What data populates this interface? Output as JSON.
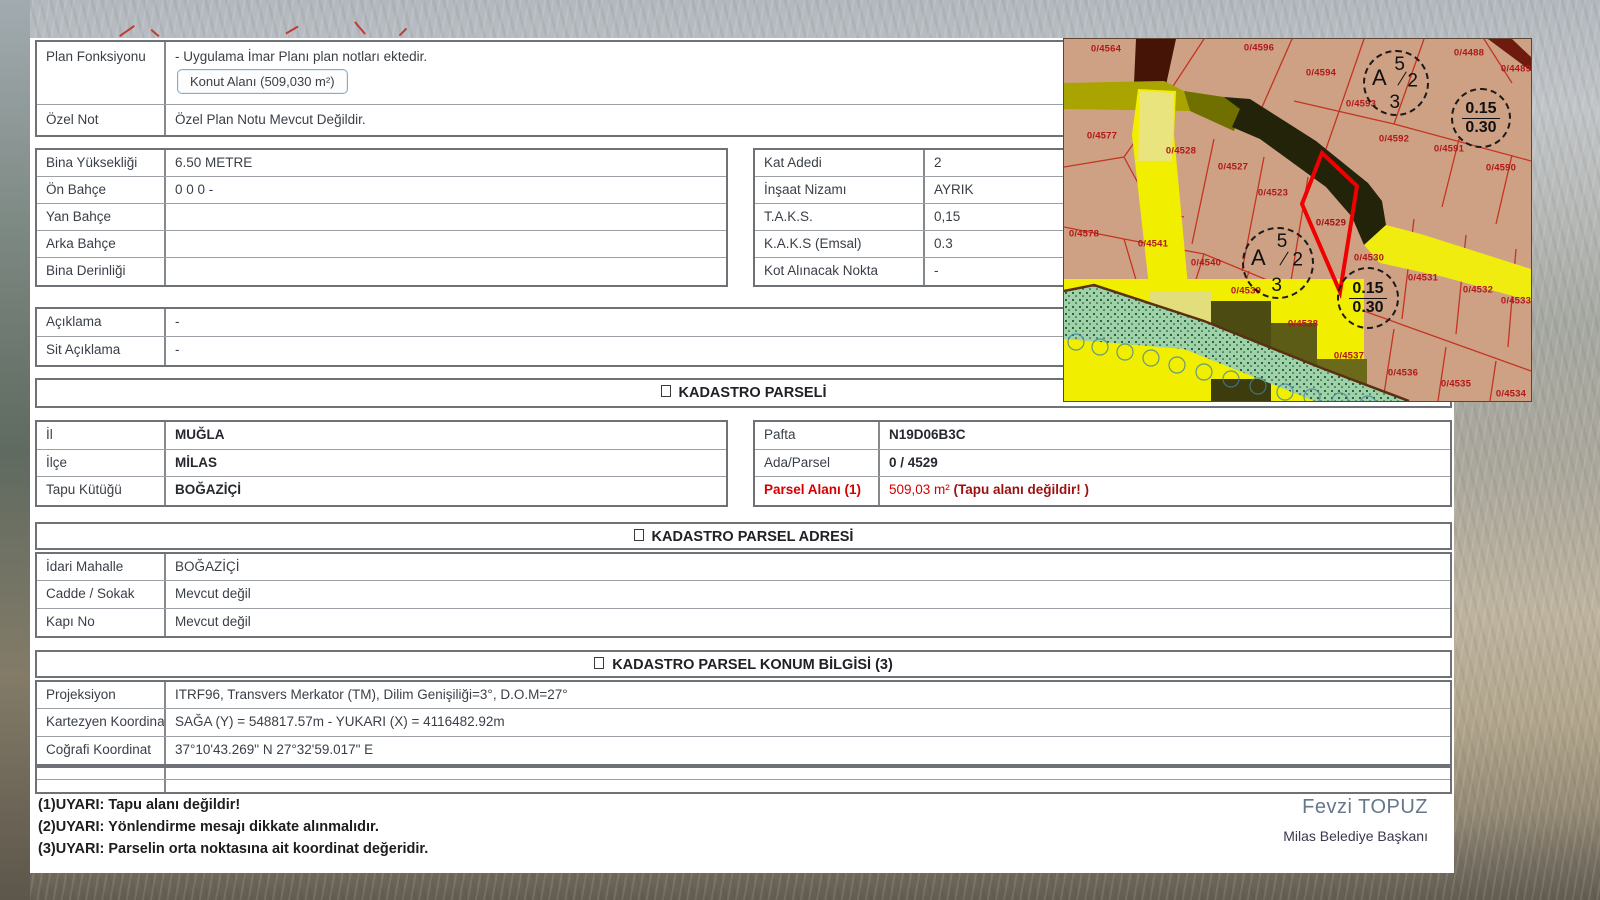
{
  "plan": {
    "rows": [
      {
        "label": "Plan Fonksiyonu",
        "text": "- Uygulama İmar Planı plan notları ektedir.",
        "button": "Konut Alanı (509,030 m²)"
      },
      {
        "label": "Özel Not",
        "value": "Özel Plan Notu Mevcut Değildir."
      }
    ]
  },
  "yapilasma_left": {
    "rows": [
      {
        "label": "Bina Yüksekliği",
        "value": "6.50 METRE"
      },
      {
        "label": "Ön Bahçe",
        "value": "0 0 0 -"
      },
      {
        "label": "Yan Bahçe",
        "value": ""
      },
      {
        "label": "Arka Bahçe",
        "value": ""
      },
      {
        "label": "Bina Derinliği",
        "value": ""
      }
    ]
  },
  "yapilasma_right": {
    "rows": [
      {
        "label": "Kat Adedi",
        "value": "2"
      },
      {
        "label": "İnşaat Nizamı",
        "value": "AYRIK"
      },
      {
        "label": "T.A.K.S.",
        "value": "0,15"
      },
      {
        "label": "K.A.K.S (Emsal)",
        "value": "0.3"
      },
      {
        "label": "Kot Alınacak Nokta",
        "value": "-"
      }
    ]
  },
  "aciklama": {
    "rows": [
      {
        "label": "Açıklama",
        "value": "-"
      },
      {
        "label": "Sit Açıklama",
        "value": "-"
      }
    ]
  },
  "kadastro_parseli": {
    "title": "KADASTRO PARSELİ",
    "left_rows": [
      {
        "label": "İl",
        "value": "MUĞLA"
      },
      {
        "label": "İlçe",
        "value": "MİLAS"
      },
      {
        "label": "Tapu Kütüğü",
        "value": "BOĞAZİÇİ"
      }
    ],
    "right_rows": [
      {
        "label": "Pafta",
        "value": "N19D06B3C"
      },
      {
        "label": "Ada/Parsel",
        "value": "0 / 4529"
      }
    ],
    "parsel_alani_label": "Parsel Alanı (1)",
    "parsel_alani_value": "509,03 m²",
    "parsel_alani_note": " (Tapu alanı değildir! )"
  },
  "adres": {
    "title": "KADASTRO PARSEL ADRESİ",
    "rows": [
      {
        "label": "İdari Mahalle",
        "value": "BOĞAZİÇİ"
      },
      {
        "label": "Cadde / Sokak",
        "value": "Mevcut değil"
      },
      {
        "label": "Kapı No",
        "value": "Mevcut değil"
      }
    ]
  },
  "konum": {
    "title": "KADASTRO PARSEL KONUM BİLGİSİ (3)",
    "rows": [
      {
        "label": "Projeksiyon",
        "value": "ITRF96, Transvers Merkator (TM), Dilim Genişiliği=3°, D.O.M=27°"
      },
      {
        "label": "Kartezyen Koordinat",
        "value": "SAĞA (Y) = 548817.57m - YUKARI (X) = 4116482.92m"
      },
      {
        "label": "Coğrafi Koordinat",
        "value": "37°10'43.269\" N 27°32'59.017\" E"
      }
    ]
  },
  "warnings": [
    "(1)UYARI: Tapu alanı değildir!",
    "(2)UYARI: Yönlendirme mesajı dikkate alınmalıdır.",
    "(3)UYARI: Parselin orta noktasına ait koordinat değeridir."
  ],
  "signature": {
    "name": "Fevzi TOPUZ",
    "title": "Milas Belediye Başkanı"
  },
  "map": {
    "selected_parcel": "0/4529",
    "colors": {
      "parcel_fill": "#cfa184",
      "selected_outline": "#f00000",
      "parcel_line": "#c23522",
      "road_yellow": "#f2ee00",
      "road_dark": "#23230a",
      "road_brown": "#451407",
      "green_area": "#9ed2a8",
      "label": "#b01818"
    },
    "labels": [
      {
        "t": "0/4564",
        "x": 42,
        "y": 10
      },
      {
        "t": "0/4596",
        "x": 195,
        "y": 9
      },
      {
        "t": "0/4594",
        "x": 257,
        "y": 34
      },
      {
        "t": "0/4488",
        "x": 405,
        "y": 14
      },
      {
        "t": "0/4489",
        "x": 452,
        "y": 30
      },
      {
        "t": "0/4593",
        "x": 297,
        "y": 65
      },
      {
        "t": "0/4592",
        "x": 330,
        "y": 100
      },
      {
        "t": "0/4591",
        "x": 385,
        "y": 110
      },
      {
        "t": "0/4590",
        "x": 437,
        "y": 129
      },
      {
        "t": "0/4577",
        "x": 38,
        "y": 97
      },
      {
        "t": "0/4528",
        "x": 117,
        "y": 112
      },
      {
        "t": "0/4527",
        "x": 169,
        "y": 128
      },
      {
        "t": "0/4523",
        "x": 209,
        "y": 154
      },
      {
        "t": "0/4529",
        "x": 267,
        "y": 184
      },
      {
        "t": "0/4578",
        "x": 20,
        "y": 195
      },
      {
        "t": "0/4541",
        "x": 89,
        "y": 205
      },
      {
        "t": "0/4540",
        "x": 142,
        "y": 224
      },
      {
        "t": "0/4539",
        "x": 182,
        "y": 252
      },
      {
        "t": "0/4530",
        "x": 305,
        "y": 219
      },
      {
        "t": "0/4531",
        "x": 359,
        "y": 239
      },
      {
        "t": "0/4532",
        "x": 414,
        "y": 251
      },
      {
        "t": "0/4533",
        "x": 452,
        "y": 262
      },
      {
        "t": "0/4538",
        "x": 239,
        "y": 285
      },
      {
        "t": "0/4537",
        "x": 285,
        "y": 317
      },
      {
        "t": "0/4536",
        "x": 339,
        "y": 334
      },
      {
        "t": "0/4535",
        "x": 392,
        "y": 345
      },
      {
        "t": "0/4534",
        "x": 447,
        "y": 355
      }
    ],
    "circles": [
      {
        "kind": "nizam",
        "x": 332,
        "y": 44,
        "r": 33,
        "top": "5",
        "left": "A",
        "right": "2",
        "bottom": "3"
      },
      {
        "kind": "ratio",
        "x": 417,
        "y": 79,
        "r": 30,
        "top": "0.15",
        "bottom": "0.30"
      },
      {
        "kind": "nizam",
        "x": 214,
        "y": 224,
        "r": 36,
        "top": "5",
        "left": "A",
        "right": "2",
        "bottom": "3"
      },
      {
        "kind": "ratio",
        "x": 304,
        "y": 259,
        "r": 31,
        "top": "0.15",
        "bottom": "0.30"
      }
    ]
  }
}
